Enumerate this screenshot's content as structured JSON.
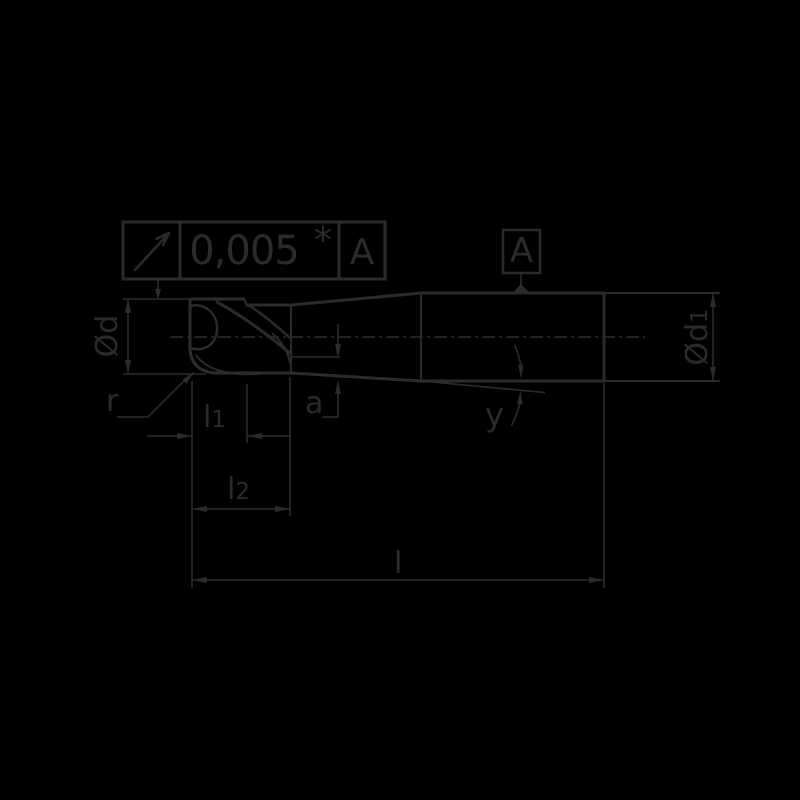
{
  "colors": {
    "background": "#000000",
    "ink": "#2e2a2b"
  },
  "tolerance_frame": {
    "symbol": "circular-runout",
    "value": "0,005",
    "marker": "*",
    "datum_ref": "A"
  },
  "datum_feature": {
    "label": "A"
  },
  "dimensions": {
    "head_diameter": "Ød",
    "shank_diameter_main": "Ød",
    "shank_diameter_sub": "1",
    "corner_radius": "r",
    "l1_main": "l",
    "l1_sub": "1",
    "l2_main": "l",
    "l2_sub": "2",
    "overall_length": "l",
    "edge_offset": "a",
    "taper_angle": "y"
  }
}
